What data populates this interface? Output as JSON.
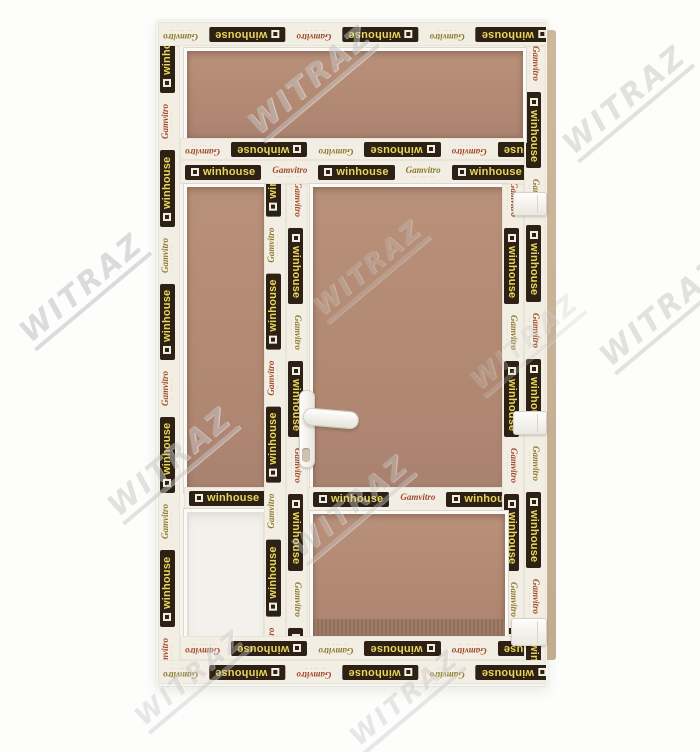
{
  "watermark": {
    "text": "WITRAZ",
    "color": "#c6c6c6"
  },
  "brand": {
    "winhouse_label": "winhouse",
    "gamvitro_label": "Gamvitro",
    "fineprint": "·· ··· ··",
    "badge_bg": "#2c2114",
    "winhouse_text_color": "#e9d65a",
    "tape_bg": "#f2eee3",
    "gamvitro_red": "#a14a2c",
    "gamvitro_gold": "#8f7a2e"
  },
  "photo": {
    "background_color": "#fdfdfc",
    "backdrop_color": "#b28a74",
    "frame_color": "#f6f4ee",
    "profile_edge_color": "#c8b49a"
  }
}
